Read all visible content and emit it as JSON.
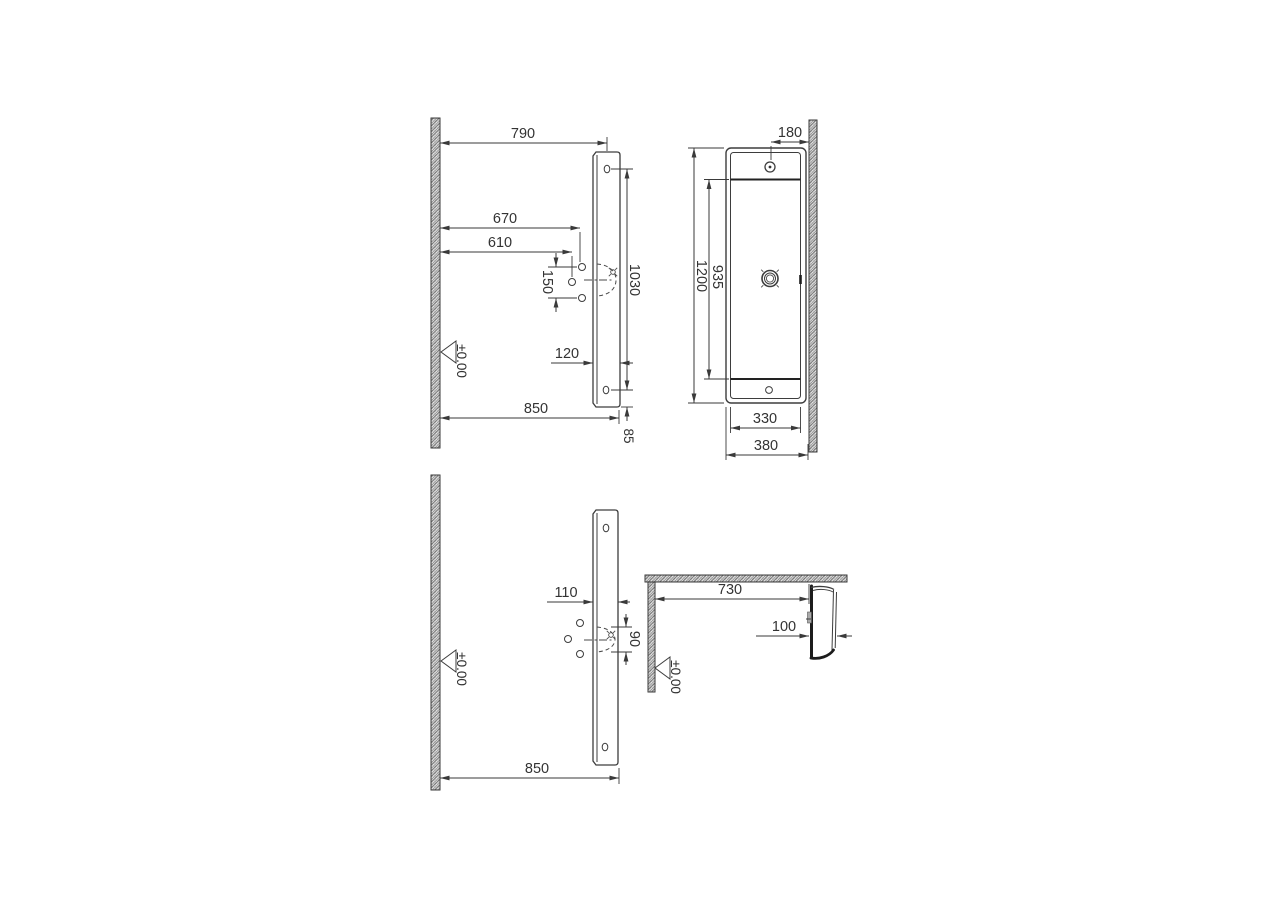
{
  "drawing": {
    "background": "#ffffff",
    "line_color": "#3a3a3a",
    "text_color": "#333333",
    "views": {
      "front_elevation": {
        "dims": {
          "top_offset": "790",
          "hole_far": "670",
          "hole_near": "610",
          "hole_spacing": "150",
          "hole_span": "1030",
          "depth": "120",
          "overall": "850",
          "end_offset": "85"
        },
        "datum": "±0.00"
      },
      "plan": {
        "dims": {
          "tap_to_wall": "180",
          "length": "1200",
          "bowl_length": "935",
          "bowl_width": "330",
          "overall_width": "380"
        }
      },
      "front_elevation_detail": {
        "dims": {
          "depth": "110",
          "drain_width": "90",
          "overall": "850"
        },
        "datum": "±0.00"
      },
      "side_section": {
        "dims": {
          "wall_to_face": "730",
          "thickness": "100"
        },
        "datum": "±0.00"
      }
    }
  }
}
